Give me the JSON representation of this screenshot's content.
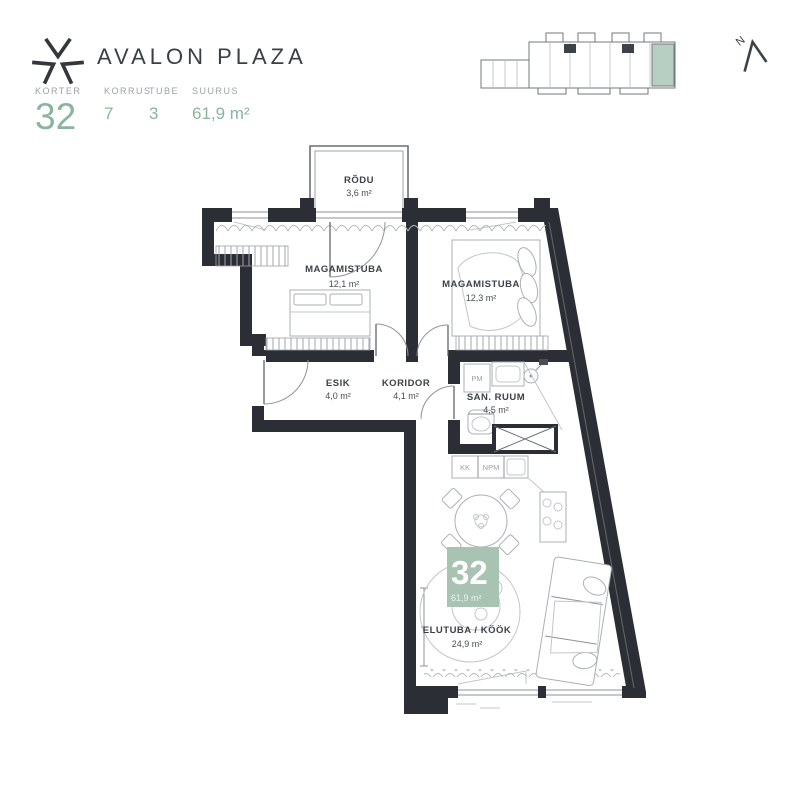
{
  "header": {
    "brand": "AVALON PLAZA",
    "info": [
      {
        "label": "KORTER",
        "value": "32"
      },
      {
        "label": "KORRUS",
        "value": "7"
      },
      {
        "label": "TUBE",
        "value": "3"
      },
      {
        "label": "SUURUS",
        "value": "61,9 m²"
      }
    ]
  },
  "compass": {
    "label": "N"
  },
  "colors": {
    "accent": "#8ab59c",
    "badge": "#a9c3b2",
    "overview_highlight": "#b6cfc2",
    "wall": "#2b2e34"
  },
  "floorplan": {
    "rooms": [
      {
        "name": "RÕDU",
        "area": "3,6 m²"
      },
      {
        "name": "MAGAMISTUBA",
        "area": "12,1 m²"
      },
      {
        "name": "MAGAMISTUBA",
        "area": "12,3 m²"
      },
      {
        "name": "ESIK",
        "area": "4,0 m²"
      },
      {
        "name": "KORIDOR",
        "area": "4,1 m²"
      },
      {
        "name": "SAN. RUUM",
        "area": "4,5 m²"
      },
      {
        "name": "ELUTUBA / KÖÖK",
        "area": "24,9 m²"
      }
    ],
    "appliance_labels": [
      "PM",
      "KK",
      "NPM"
    ],
    "badge": {
      "number": "32",
      "area": "61,9 m²"
    }
  }
}
